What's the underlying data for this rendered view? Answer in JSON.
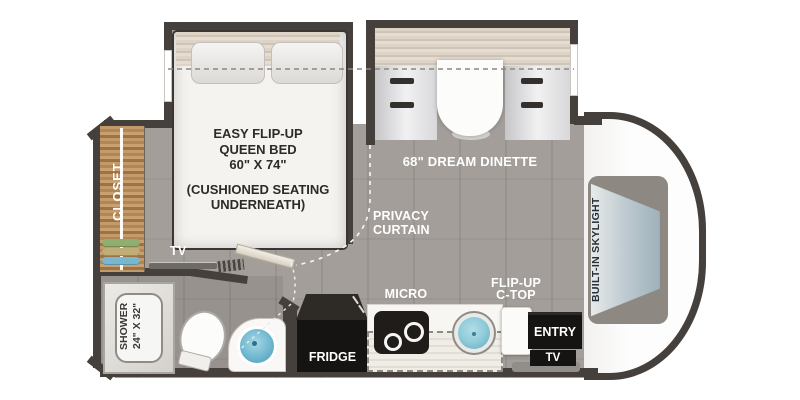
{
  "title": "RV floor plan",
  "colors": {
    "wall": "#45403c",
    "floor": "#a39e9a",
    "closet_wood": "#b08653",
    "water_blue": "#6fb7cf",
    "cab_white": "#fdfdfd",
    "skylight_panel": "#8d8882",
    "label_white": "#ffffff",
    "label_dark": "#2d2a27"
  },
  "labels": {
    "bed": {
      "l1": "EASY FLIP-UP",
      "l2": "QUEEN BED",
      "l3": "60\" X 74\"",
      "note1": "(CUSHIONED SEATING",
      "note2": "UNDERNEATH)"
    },
    "dinette": "68\" DREAM DINETTE",
    "privacy": {
      "l1": "PRIVACY",
      "l2": "CURTAIN"
    },
    "closet": "CLOSET",
    "skylight": "BUILT-IN SKYLIGHT",
    "tv_bedroom": "TV",
    "shower": {
      "l1": "SHOWER",
      "l2": "24\" X 32\""
    },
    "fridge": "FRIDGE",
    "micro": "MICRO",
    "flip": {
      "l1": "FLIP-UP",
      "l2": "C-TOP"
    },
    "entry": "ENTRY",
    "tv_entry": "TV"
  }
}
